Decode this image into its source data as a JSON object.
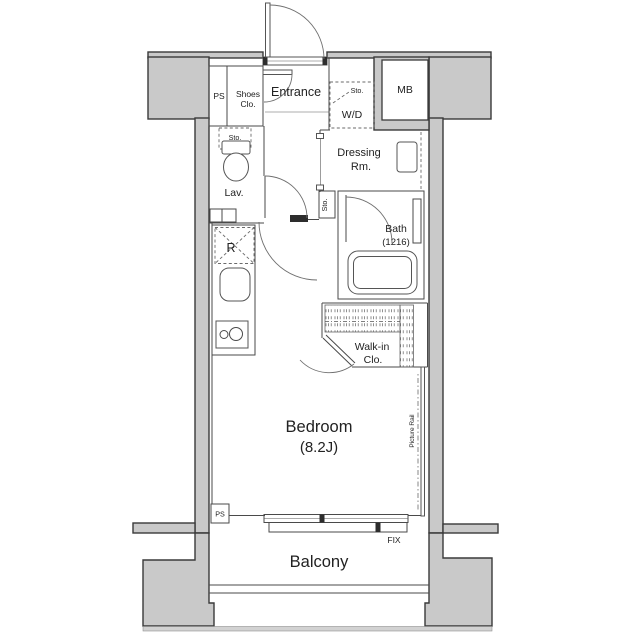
{
  "meta": {
    "type": "apartment-floorplan"
  },
  "colors": {
    "wall_fill": "#c9c9c9",
    "wall_edge": "#3a3a3a",
    "line": "#4a4a4a",
    "text": "#222222",
    "band": "#d2d2d2"
  },
  "labels": {
    "ps_top": "PS",
    "shoes_line1": "Shoes",
    "shoes_line2": "Clo.",
    "entrance": "Entrance",
    "sto_wd": "Sto.",
    "wd": "W/D",
    "mb": "MB",
    "dressing_line1": "Dressing",
    "dressing_line2": "Rm.",
    "sto_toilet": "Sto.",
    "lav": "Lav.",
    "sto_hall": "Sto.",
    "fridge": "R",
    "bath_line1": "Bath",
    "bath_line2": "(1216)",
    "walkin_line1": "Walk-in",
    "walkin_line2": "Clo.",
    "bedroom_line1": "Bedroom",
    "bedroom_line2": "(8.2J)",
    "picture_rail": "Picture Rail",
    "ps_bottom": "PS",
    "fix": "FIX",
    "balcony": "Balcony"
  }
}
